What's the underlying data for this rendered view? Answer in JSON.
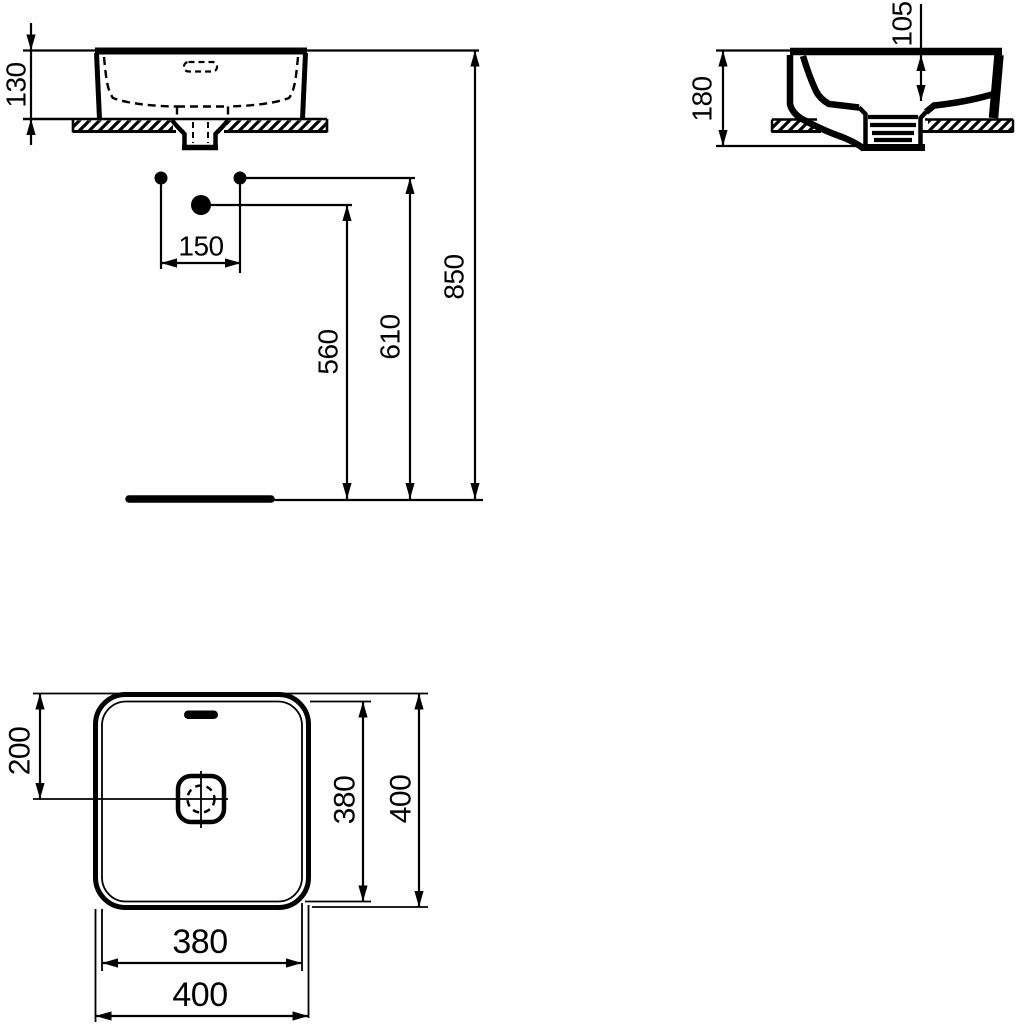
{
  "drawing": {
    "type": "technical-dimension-drawing",
    "subject": "square vessel washbasin on countertop",
    "units": "mm",
    "line_color": "#000000",
    "background_color": "#ffffff",
    "front_view": {
      "basin_height_above_counter": "130",
      "tap_hole_spacing": "150",
      "drain_outlet_height": "560",
      "tap_hole_height": "610",
      "rim_height_from_floor": "850"
    },
    "side_view": {
      "total_basin_height": "180",
      "inner_bowl_depth": "105"
    },
    "plan_view": {
      "front_edge_to_drain_center": "200",
      "inner_depth": "380",
      "outer_depth": "400",
      "inner_width": "380",
      "outer_width": "400"
    }
  }
}
